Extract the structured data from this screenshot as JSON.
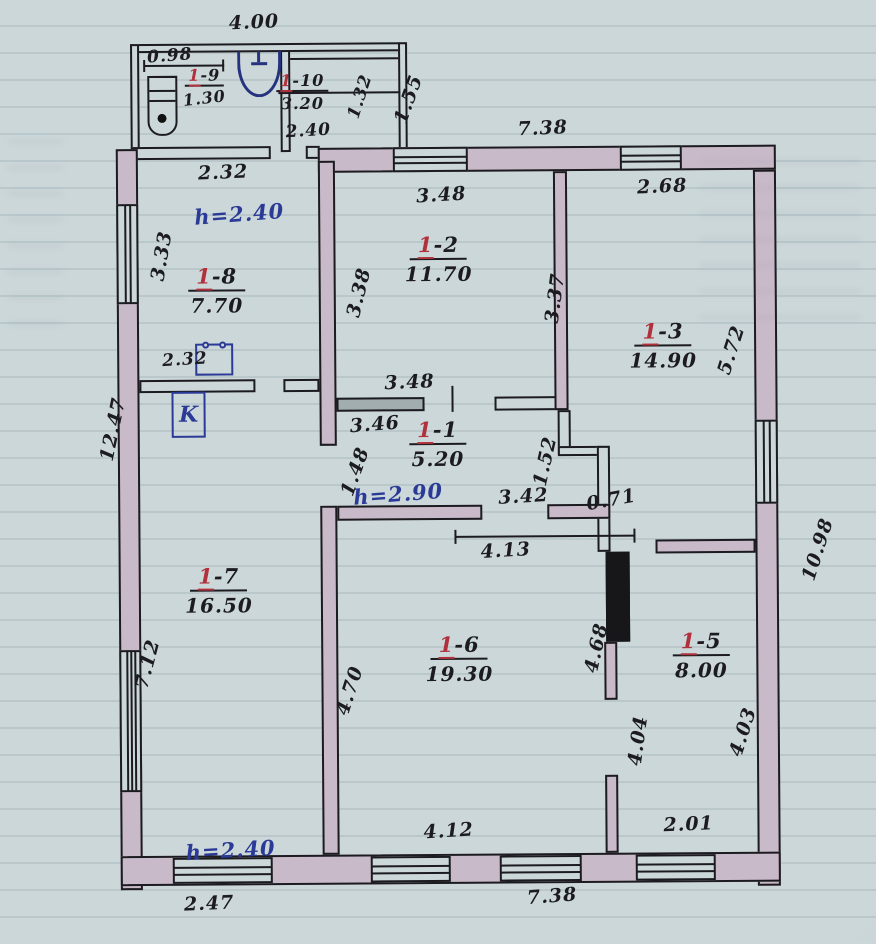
{
  "palette": {
    "paper": "#ccd7d9",
    "ink": "#1b1b20",
    "wall_fill": "#c9bac9",
    "red": "#b0303c",
    "blue": "#2b3a96"
  },
  "rooms": [
    {
      "id": "1-9",
      "red": "1",
      "suffix": "-9",
      "area": "1.30"
    },
    {
      "id": "1-10",
      "red": "1",
      "suffix": "-10",
      "area": "3.20"
    },
    {
      "id": "1-8",
      "red": "1",
      "suffix": "-8",
      "area": "7.70"
    },
    {
      "id": "1-2",
      "red": "1",
      "suffix": "-2",
      "area": "11.70"
    },
    {
      "id": "1-3",
      "red": "1",
      "suffix": "-3",
      "area": "14.90"
    },
    {
      "id": "1-1",
      "red": "1",
      "suffix": "-1",
      "area": "5.20"
    },
    {
      "id": "1-7",
      "red": "1",
      "suffix": "-7",
      "area": "16.50"
    },
    {
      "id": "1-6",
      "red": "1",
      "suffix": "-6",
      "area": "19.30"
    },
    {
      "id": "1-5",
      "red": "1",
      "suffix": "-5",
      "area": "8.00"
    }
  ],
  "heights": {
    "room_1_8": "h=2.40",
    "room_1_1": "h=2.90",
    "room_1_7": "h=2.40"
  },
  "fixtures": {
    "boiler_label": "K"
  },
  "dims": {
    "annex_width_top": "4.00",
    "room9_width": "0.98",
    "room10_width": "2.40",
    "room10_depth": "1.32",
    "annex_depth": "1.55",
    "main_top_width": "7.38",
    "room8_width_top": "2.32",
    "room8_left": "3.33",
    "stove_width": "2.32",
    "room2_top": "3.48",
    "room3_top": "2.68",
    "room2_left": "3.38",
    "room2_right": "3.37",
    "room2_bottom": "3.48",
    "room3_right": "5.72",
    "room1_top": "3.46",
    "room1_left": "1.48",
    "room1_bottom": "3.42",
    "room1_right": "1.52",
    "corridor_ext": "0.71",
    "room6_top": "4.13",
    "left_side_total": "12.47",
    "left_side_lower": "7.12",
    "room6_left": "4.70",
    "room6_right": "4.68",
    "room5_left": "4.04",
    "room5_right": "4.03",
    "room5_bottom": "2.01",
    "room6_bottom": "4.12",
    "right_side_total": "10.98",
    "bottom_left_width": "2.47",
    "bottom_main_width": "7.38"
  }
}
